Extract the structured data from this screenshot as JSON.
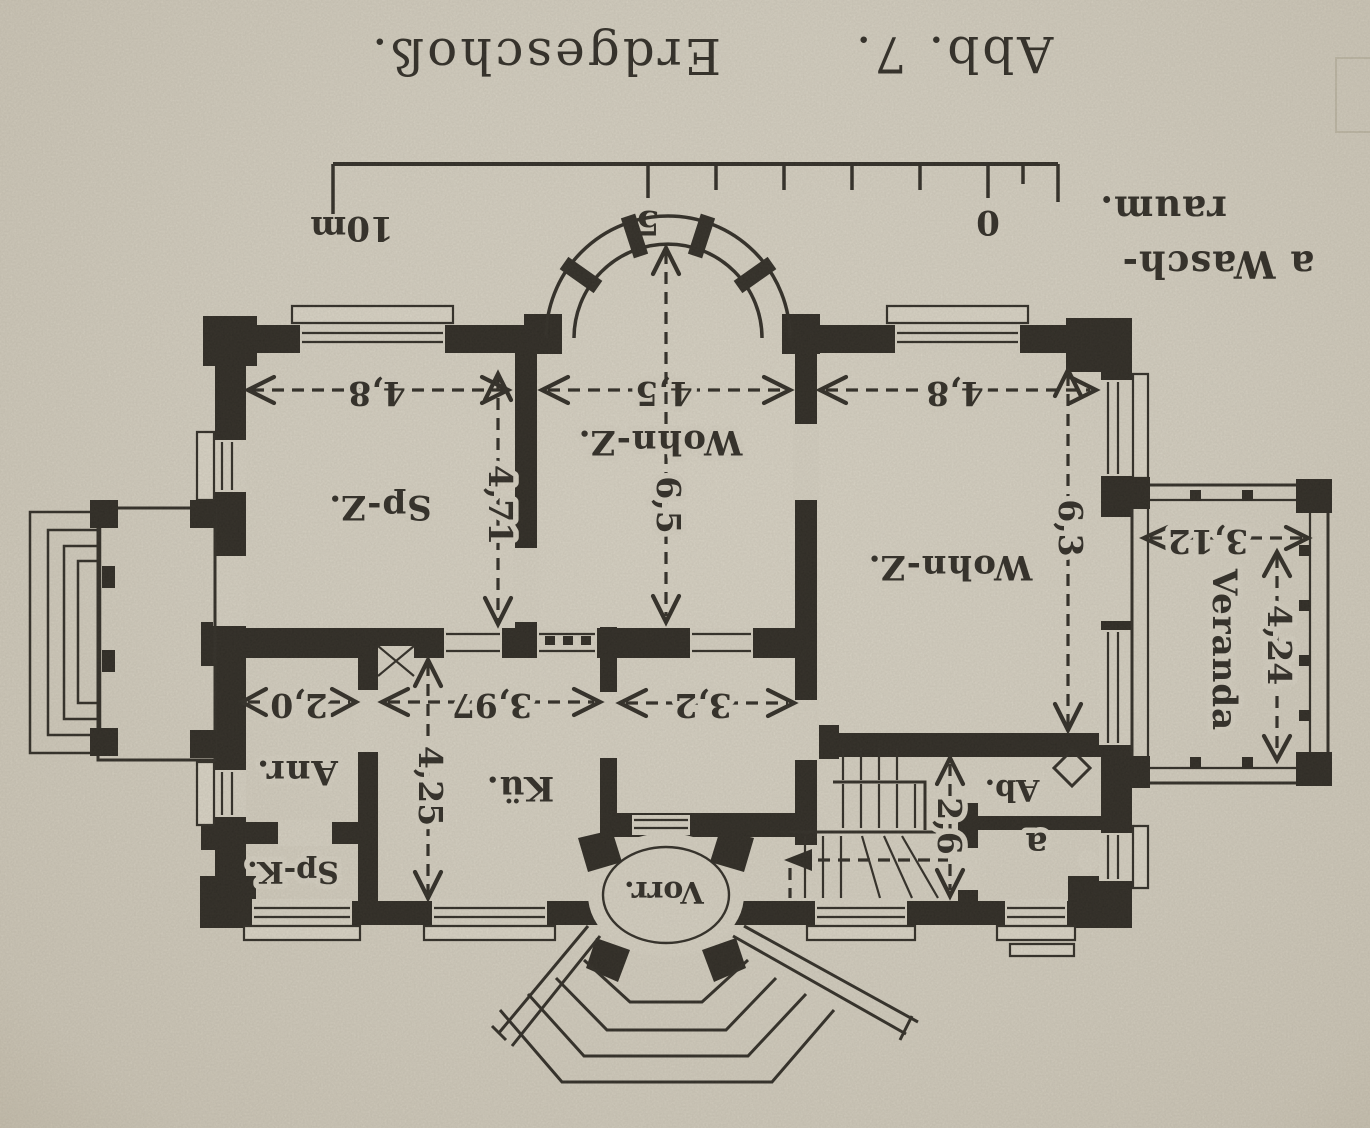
{
  "caption": {
    "figure": "Abb. 7.",
    "title": "Erdgeschoß."
  },
  "scale_bar": {
    "m10": "10m",
    "m5": "5",
    "m0": "0"
  },
  "legend": {
    "line1": "a Wasch-",
    "line2": "raum."
  },
  "rooms": {
    "sp_z": "Sp-Z.",
    "wohn_mid": "Wohn-Z.",
    "wohn_right": "Wohn-Z.",
    "anr": "Anr.",
    "sp_k": "Sp-K.",
    "kueche": "Kü.",
    "ab": "Ab.",
    "a": "a",
    "vorr": "Vorr.",
    "veranda": "Veranda"
  },
  "dimensions": {
    "sp_z_w": "4,8",
    "sp_z_d": "4,71",
    "wohn_mid_w": "4,5",
    "wohn_mid_d": "6,5",
    "wohn_right_w": "4,8",
    "wohn_right_d": "6,3",
    "veranda_w": "3,12",
    "veranda_d": "4,24",
    "anr_w": "2,0",
    "kueche_w": "3,97",
    "kueche_d": "4,25",
    "flur_w": "3,2",
    "treppe_w": "2,6"
  },
  "colors": {
    "paper": "#d9d4c6",
    "ink": "#2e2b25"
  }
}
